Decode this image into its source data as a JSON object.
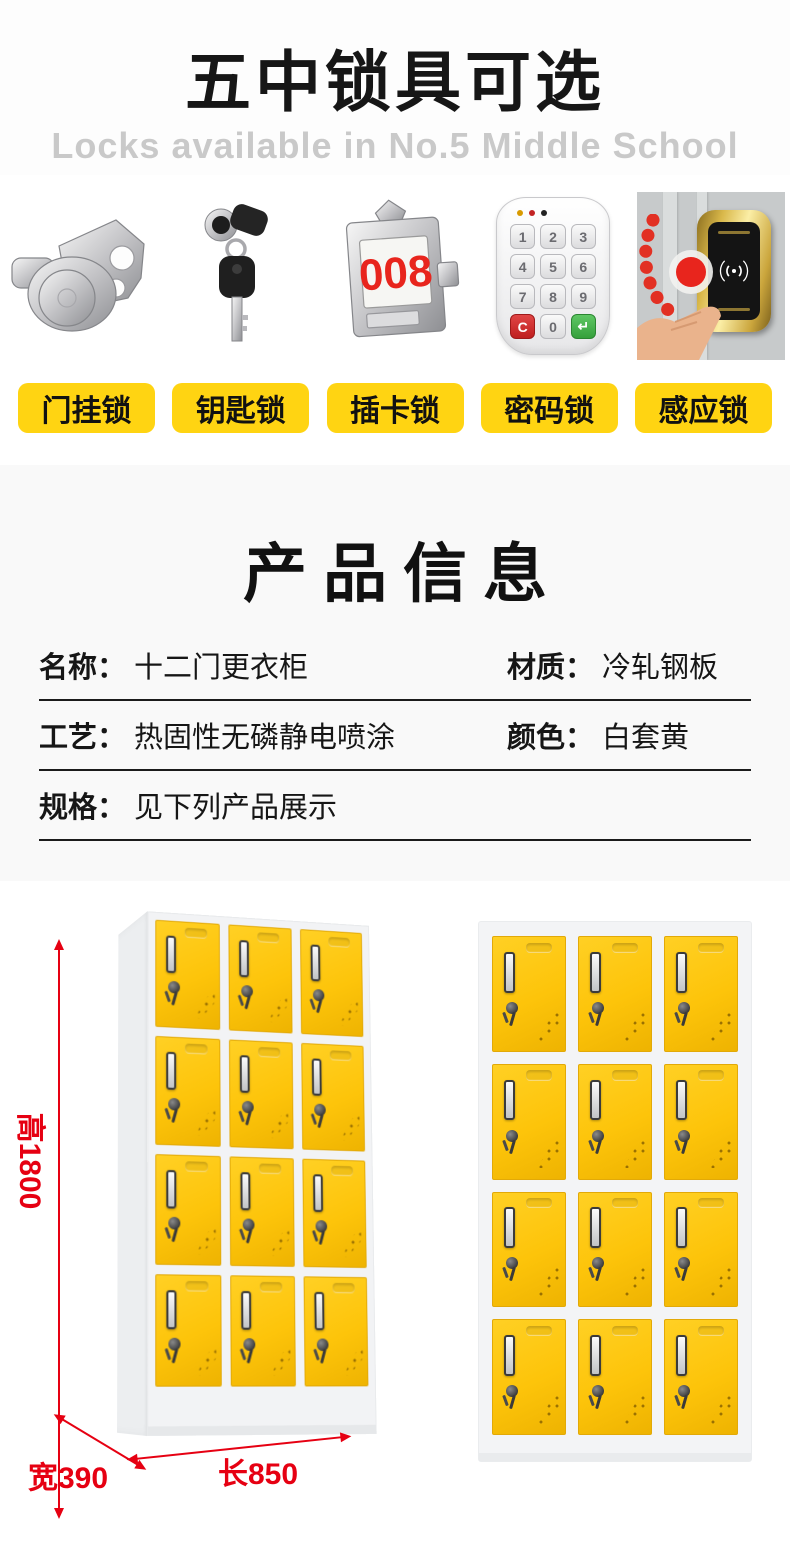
{
  "header": {
    "title": "五中锁具可选",
    "subtitle": "Locks available in No.5 Middle School"
  },
  "locks": {
    "items": [
      {
        "label": "门挂锁",
        "icon": "cam-lock-icon"
      },
      {
        "label": "钥匙锁",
        "icon": "key-lock-icon"
      },
      {
        "label": "插卡锁",
        "icon": "card-lock-icon",
        "number": "008"
      },
      {
        "label": "密码锁",
        "icon": "keypad-lock-icon",
        "keys": [
          "1",
          "2",
          "3",
          "4",
          "5",
          "6",
          "7",
          "8",
          "9",
          "C",
          "0",
          "↵"
        ]
      },
      {
        "label": "感应锁",
        "icon": "induction-lock-icon"
      }
    ],
    "label_bg": "#ffd412"
  },
  "product_info": {
    "title": "产品信息",
    "rows": [
      [
        {
          "label": "名称：",
          "value": "十二门更衣柜"
        },
        {
          "label": "材质：",
          "value": "冷轧钢板"
        }
      ],
      [
        {
          "label": "工艺：",
          "value": "热固性无磷静电喷涂"
        },
        {
          "label": "颜色：",
          "value": "白套黄"
        }
      ],
      [
        {
          "label": "规格：",
          "value": "见下列产品展示"
        }
      ]
    ]
  },
  "dimensions": {
    "height": "高1800",
    "width": "宽390",
    "length": "长850",
    "accent_color": "#e60012"
  },
  "cabinet": {
    "rows": 4,
    "cols": 3,
    "door_color": "#fdc40a",
    "frame_color": "#f3f4f6"
  }
}
